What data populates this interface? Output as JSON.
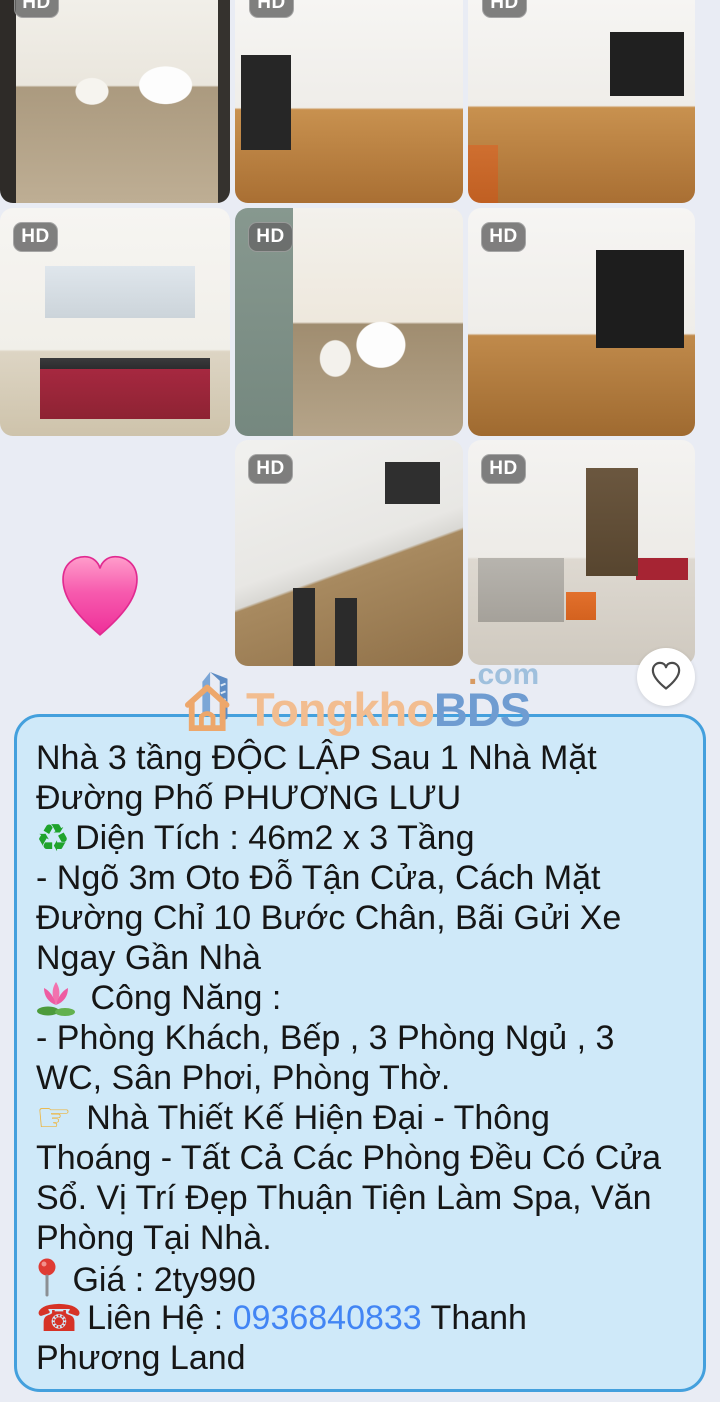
{
  "colors": {
    "page_bg": "#e9ecf4",
    "box_bg": "#cfe9f9",
    "box_border": "#44a0dd",
    "text": "#161616",
    "link_blue": "#4285f4",
    "brand_orange": "#f2bd90",
    "brand_blue": "#6f9cd1",
    "hd_badge_bg": "#686868"
  },
  "photo_grid": {
    "badge_label": "HD",
    "photos": [
      {
        "label": "bathroom with toilet, sink, mirror and shower"
      },
      {
        "label": "empty room with wood floor and window on left"
      },
      {
        "label": "empty room with wood floor and orange box"
      },
      {
        "label": "kitchen with red and white cabinets"
      },
      {
        "label": "bathroom with toilet, sink and water heater"
      },
      {
        "label": "empty room with barred window and wood floor"
      },
      {
        "label": "white building exterior with brown lower wall"
      },
      {
        "label": "living room with gray sofa, orange ottoman and kitchen"
      }
    ]
  },
  "sticker": {
    "icon": "pink-heart"
  },
  "favorite_button": {
    "icon": "heart-outline"
  },
  "logo": {
    "brand_first": "Tongkho",
    "brand_second": "BDS",
    "tld_dot": ".",
    "tld": "com"
  },
  "listing": {
    "lines": [
      {
        "segments": [
          {
            "t": "text",
            "v": "Nhà 3 tầng ĐỘC LẬP Sau 1 Nhà Mặt"
          }
        ]
      },
      {
        "segments": [
          {
            "t": "text",
            "v": "Đường Phố PHƯƠNG LƯU"
          }
        ]
      },
      {
        "segments": [
          {
            "t": "icon",
            "v": "recycle"
          },
          {
            "t": "text",
            "v": "Diện Tích : 46m2 x 3 Tầng"
          }
        ]
      },
      {
        "segments": [
          {
            "t": "text",
            "v": "- Ngõ 3m Oto Đỗ Tận Cửa, Cách Mặt"
          }
        ]
      },
      {
        "segments": [
          {
            "t": "text",
            "v": "Đường Chỉ 10 Bước Chân, Bãi Gửi Xe"
          }
        ]
      },
      {
        "segments": [
          {
            "t": "text",
            "v": "Ngay Gần Nhà"
          }
        ]
      },
      {
        "segments": [
          {
            "t": "icon",
            "v": "lotus"
          },
          {
            "t": "text",
            "v": " Công Năng :"
          }
        ]
      },
      {
        "segments": [
          {
            "t": "text",
            "v": "- Phòng Khách, Bếp , 3 Phòng Ngủ , 3"
          }
        ]
      },
      {
        "segments": [
          {
            "t": "text",
            "v": "WC, Sân Phơi, Phòng Thờ."
          }
        ]
      },
      {
        "segments": [
          {
            "t": "icon",
            "v": "point"
          },
          {
            "t": "text",
            "v": " Nhà Thiết Kế Hiện Đại - Thông"
          }
        ]
      },
      {
        "segments": [
          {
            "t": "text",
            "v": "Thoáng - Tất Cả Các Phòng Đều Có Cửa"
          }
        ]
      },
      {
        "segments": [
          {
            "t": "text",
            "v": "Sổ. Vị Trí Đẹp Thuận Tiện Làm Spa, Văn"
          }
        ]
      },
      {
        "segments": [
          {
            "t": "text",
            "v": "Phòng Tại Nhà."
          }
        ]
      },
      {
        "segments": [
          {
            "t": "icon",
            "v": "pushpin"
          },
          {
            "t": "text",
            "v": "  Giá : 2ty990"
          }
        ]
      },
      {
        "segments": [
          {
            "t": "icon",
            "v": "telephone"
          },
          {
            "t": "text",
            "v": "Liên Hệ : "
          },
          {
            "t": "link",
            "v": "0936840833"
          },
          {
            "t": "text",
            "v": " Thanh"
          }
        ]
      },
      {
        "segments": [
          {
            "t": "text",
            "v": "Phương Land"
          }
        ]
      }
    ]
  }
}
